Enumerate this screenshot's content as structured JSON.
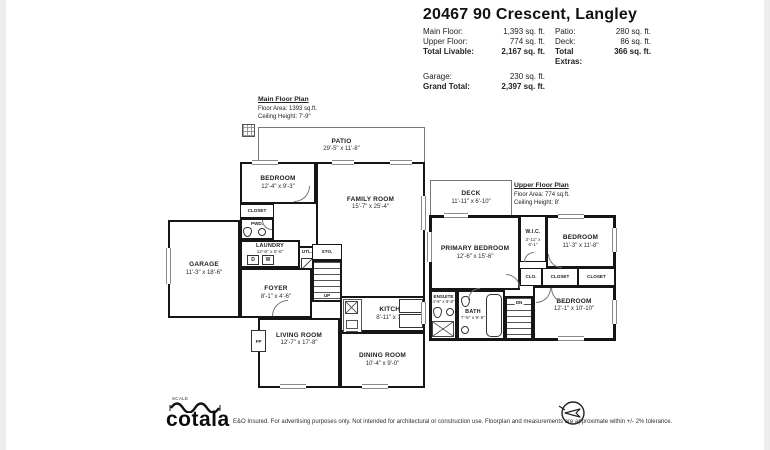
{
  "header": {
    "title": "20467 90 Crescent, Langley",
    "stats": {
      "rows": [
        {
          "l1": "Main Floor:",
          "v1": "1,393 sq. ft.",
          "l2": "Patio:",
          "v2": "280 sq. ft."
        },
        {
          "l1": "Upper Floor:",
          "v1": "774 sq. ft.",
          "l2": "Deck:",
          "v2": "86 sq. ft."
        },
        {
          "l1": "Total Livable:",
          "v1": "2,167 sq. ft.",
          "l2": "Total Extras:",
          "v2": "366 sq. ft."
        }
      ],
      "garage_label": "Garage:",
      "garage_value": "230 sq. ft.",
      "grand_label": "Grand Total:",
      "grand_value": "2,397 sq. ft."
    }
  },
  "main_floor": {
    "plan_title": "Main Floor Plan",
    "floor_area": "Floor Area: 1393 sq.ft.",
    "ceiling_height": "Ceiling Height: 7'-9\"",
    "labels": {
      "washer": "W",
      "dryer": "D",
      "fireplace": "FP",
      "up": "UP"
    },
    "rooms": {
      "patio": {
        "name": "PATIO",
        "dims": "29'-5\" x 11'-8\""
      },
      "bedroom": {
        "name": "BEDROOM",
        "dims": "12'-4\" x 9'-3\""
      },
      "closet": {
        "name": "CLOSET"
      },
      "pwd": {
        "name": "PWD."
      },
      "laundry": {
        "name": "LAUNDRY",
        "dims": "12'-6\" x 5'-6\""
      },
      "utility": {
        "name": "UTL."
      },
      "storage": {
        "name": "STO."
      },
      "foyer": {
        "name": "FOYER",
        "dims": "8'-1\" x 4'-6\""
      },
      "garage": {
        "name": "GARAGE",
        "dims": "11'-3\" x 18'-6\""
      },
      "family": {
        "name": "FAMILY ROOM",
        "dims": "15'-7\" x 25'-4\""
      },
      "living": {
        "name": "LIVING ROOM",
        "dims": "12'-7\" x 17'-8\""
      },
      "kitchen": {
        "name": "KITCHEN",
        "dims": "8'-11\" x 14'-8\""
      },
      "dining": {
        "name": "DINING ROOM",
        "dims": "10'-4\" x 9'-0\""
      }
    }
  },
  "upper_floor": {
    "plan_title": "Upper Floor Plan",
    "floor_area": "Floor Area: 774 sq.ft.",
    "ceiling_height": "Ceiling Height: 8'",
    "labels": {
      "down": "DN"
    },
    "rooms": {
      "deck": {
        "name": "DECK",
        "dims": "11'-11\" x 6'-10\""
      },
      "primary": {
        "name": "PRIMARY BEDROOM",
        "dims": "12'-6\" x 15'-6\""
      },
      "wic": {
        "name": "W.I.C.",
        "dims": "3'-11\" x 6'-1\""
      },
      "bedroom2": {
        "name": "BEDROOM",
        "dims": "11'-3\" x 11'-8\""
      },
      "clo": {
        "name": "CLO."
      },
      "closet1": {
        "name": "CLOSET"
      },
      "closet2": {
        "name": "CLOSET"
      },
      "ensuite": {
        "name": "ENSUITE",
        "dims": "4'-8\" x 9'-8\""
      },
      "bath": {
        "name": "BATH",
        "dims": "7'-5\" x 9'-5\""
      },
      "bedroom3": {
        "name": "BEDROOM",
        "dims": "12'-1\" x 10'-10\""
      }
    }
  },
  "footer": {
    "scale_label": "SCALE",
    "logo": "cotala",
    "disclaimer": "E&O Insured. For advertising purposes only. Not intended for architectural or construction use. Floorplan and measurements are approximate within +/- 2% tolerance."
  }
}
